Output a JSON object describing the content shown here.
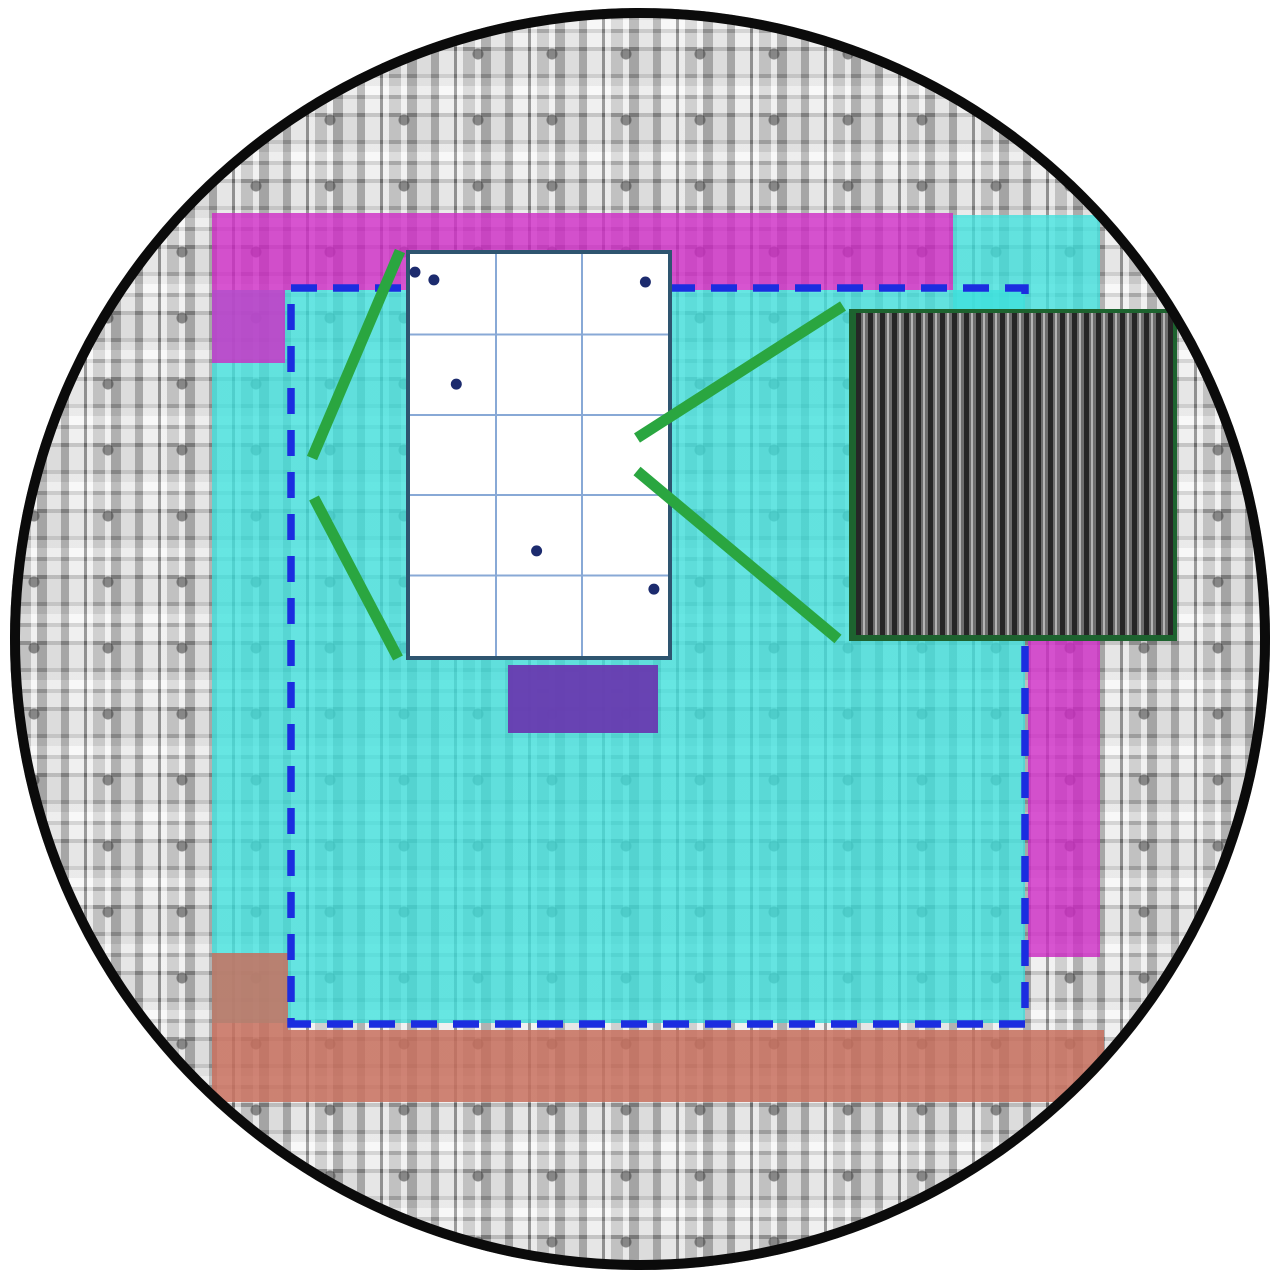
{
  "figure": {
    "kind": "wafer-map-diagram",
    "visible_text": ""
  },
  "colors": {
    "background": "#ffffff",
    "wafer_edge": "#0b0b0b",
    "die_mosaic_base": "#c2c2c2",
    "region_cyan": "#3ee0dc",
    "region_magenta": "#ce2ac6",
    "region_salmon": "#c8705e",
    "region_purple": "#683bb0",
    "dashed_outline_blue": "#1b2de0",
    "callout_green": "#2aa640",
    "sem_border_green": "#1d632f",
    "inset_border": "#2e5570",
    "inset_gridline": "#88a9d6",
    "defect_dot": "#1c2b6e"
  },
  "wafer": {
    "shape": "circle",
    "fill": "repeating gray die mosaic"
  },
  "regions": [
    {
      "id": "magenta-top-band",
      "color_key": "region_magenta"
    },
    {
      "id": "magenta-left-extension",
      "color_key": "region_magenta"
    },
    {
      "id": "magenta-right-column",
      "color_key": "region_magenta"
    },
    {
      "id": "cyan-main-area",
      "color_key": "region_cyan"
    },
    {
      "id": "cyan-top-right-block",
      "color_key": "region_cyan"
    },
    {
      "id": "salmon-left-column",
      "color_key": "region_salmon"
    },
    {
      "id": "salmon-bottom-band",
      "color_key": "region_salmon"
    },
    {
      "id": "purple-block",
      "color_key": "region_purple"
    }
  ],
  "inset_die_map": {
    "columns": 3,
    "rows": 5,
    "defect_count": 6,
    "defects": [
      {
        "fx": 0.034,
        "fy": 0.054
      },
      {
        "fx": 0.105,
        "fy": 0.073
      },
      {
        "fx": 0.9,
        "fy": 0.078
      },
      {
        "fx": 0.189,
        "fy": 0.327
      },
      {
        "fx": 0.491,
        "fy": 0.734
      },
      {
        "fx": 0.932,
        "fy": 0.827
      }
    ]
  },
  "sem_patch": {
    "stripe_orientation": "vertical",
    "stripe_count": 27
  },
  "annotations": {
    "dashed_rectangle": true,
    "callout_line_count": 4
  }
}
